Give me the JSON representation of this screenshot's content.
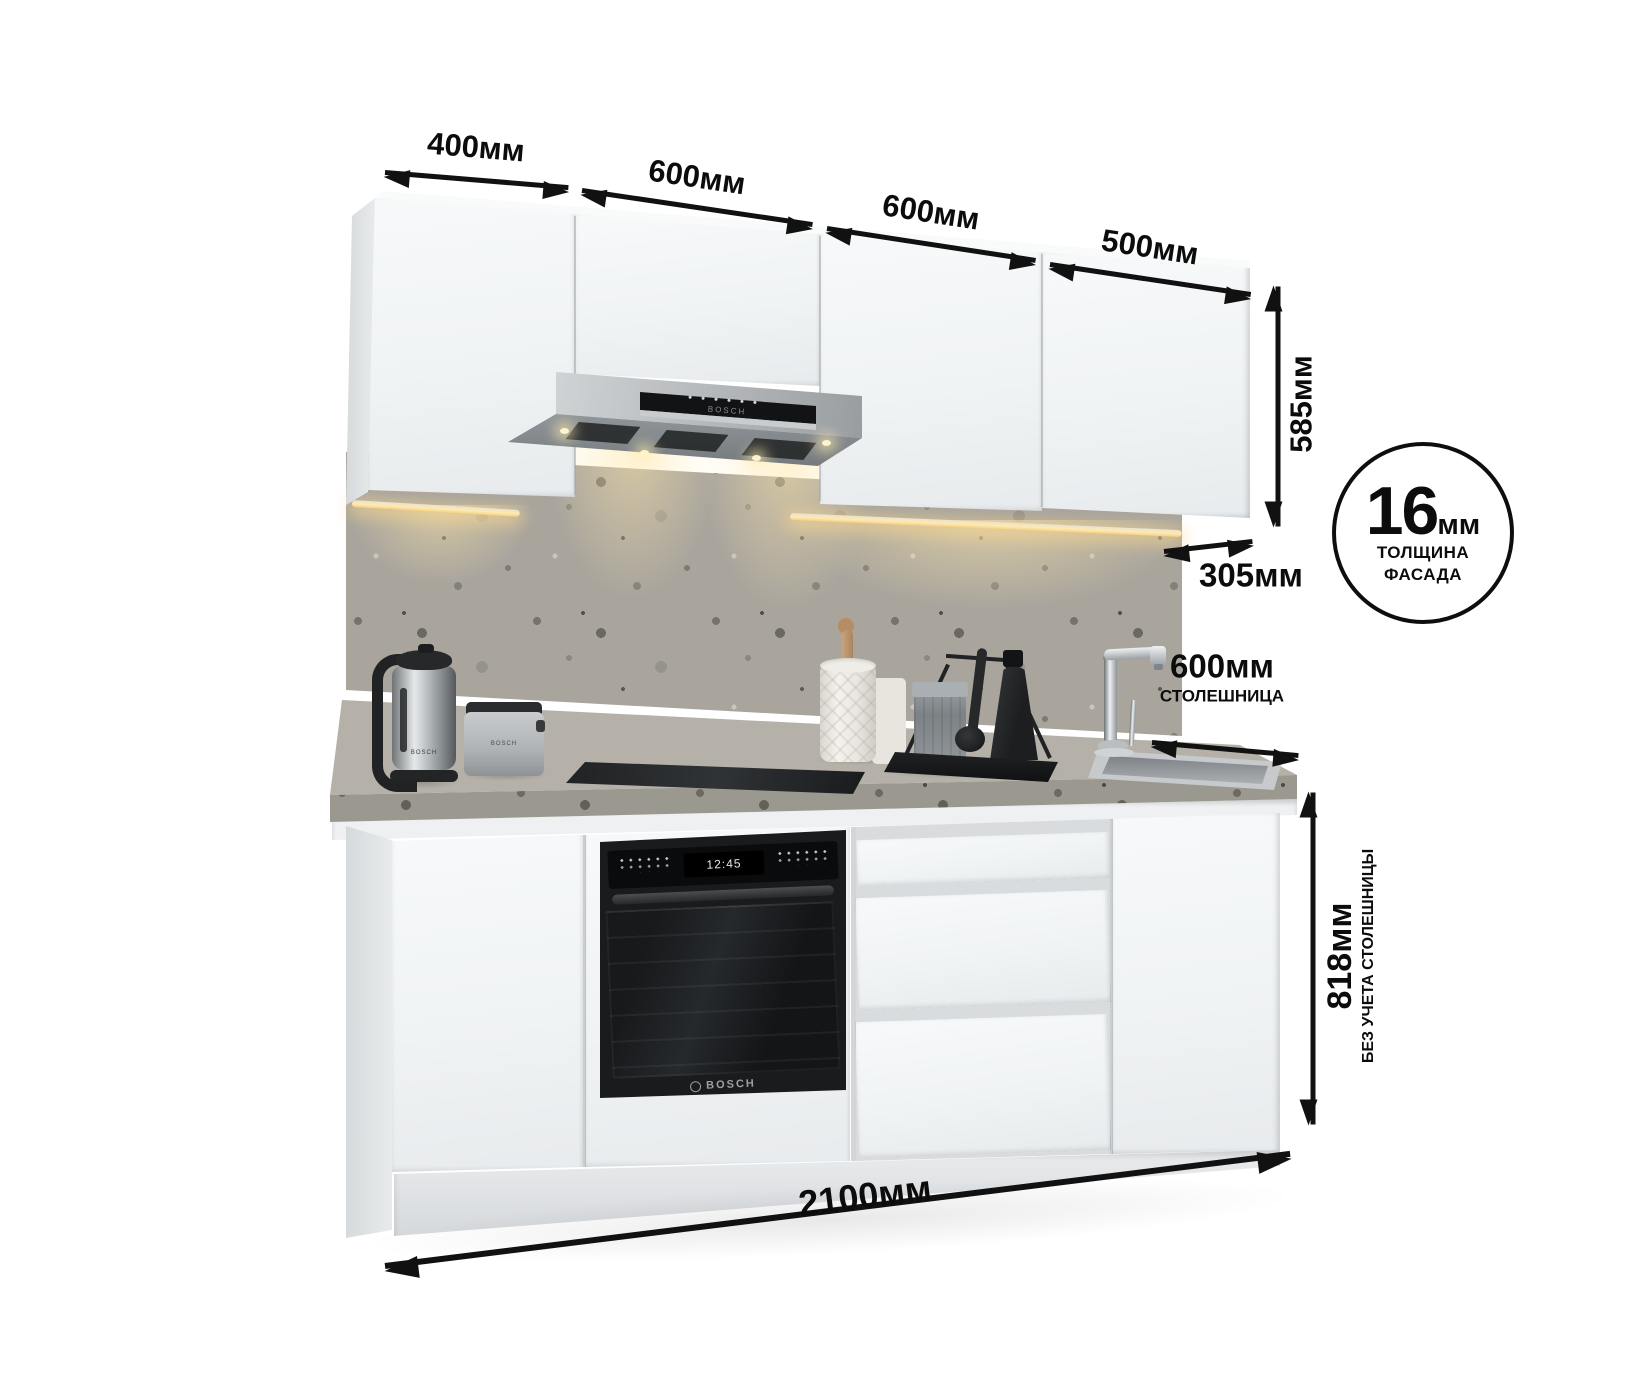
{
  "product": {
    "type": "kitchen-set-dimension-render"
  },
  "dimensions": {
    "wall_widths": [
      "400мм",
      "600мм",
      "600мм",
      "500мм"
    ],
    "wall_height": "585мм",
    "wall_depth": "305мм",
    "facade": {
      "value": "16",
      "unit": "мм",
      "caption_line1": "ТОЛЩИНА",
      "caption_line2": "ФАСАДА"
    },
    "worktop": {
      "value": "600мм",
      "caption": "СТОЛЕШНИЦА"
    },
    "base_height": {
      "value": "818мм",
      "caption": "БЕЗ УЧЕТА СТОЛЕШНИЦЫ"
    },
    "total_width": "2100мм"
  },
  "appliances": {
    "oven": {
      "brand": "BOSCH",
      "clock": "12:45"
    },
    "hood": {
      "brand": "BOSCH"
    },
    "kettle": {
      "brand": "BOSCH"
    },
    "toaster": {
      "brand": "BOSCH"
    }
  },
  "colors": {
    "annotation": "#111111",
    "cabinet_front": "#f2f4f5",
    "counter_stone": "#aba79f",
    "backsplash_stone": "#a9a59d",
    "appliance_dark": "#1b1d1f",
    "led_warm": "#ffe9ae"
  }
}
